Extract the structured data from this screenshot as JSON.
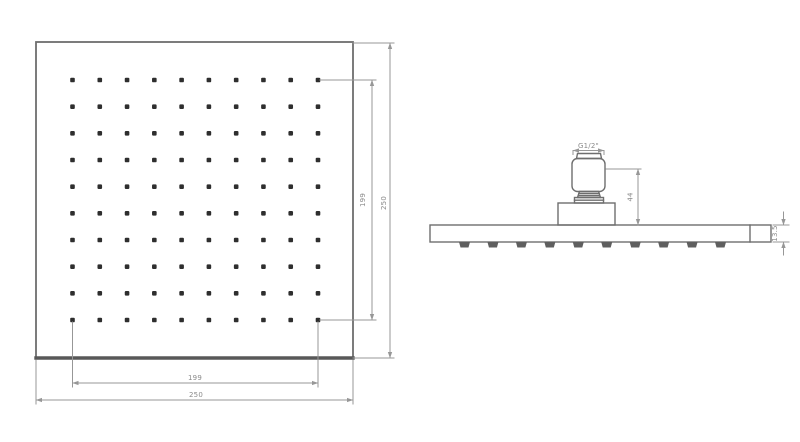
{
  "title": "square-rain-shower-head-technical-drawing",
  "colors": {
    "background": "#ffffff",
    "line": "#6e6e6e",
    "line_dark": "#585858",
    "dim": "#979797",
    "dim_text": "#8a8a8a",
    "dot": "#2e2e2e",
    "nozzle": "#5f5f5f"
  },
  "drawing": {
    "front_view": {
      "grid": {
        "rows": 10,
        "cols": 10
      },
      "dim_width_outer": "250",
      "dim_width_inner": "199",
      "dim_height_outer": "250",
      "dim_height_inner": "199"
    },
    "side_view": {
      "nozzle_count": 10,
      "dim_thread": "G1/2\"",
      "dim_height": "44",
      "dim_thickness": "13.5"
    }
  }
}
